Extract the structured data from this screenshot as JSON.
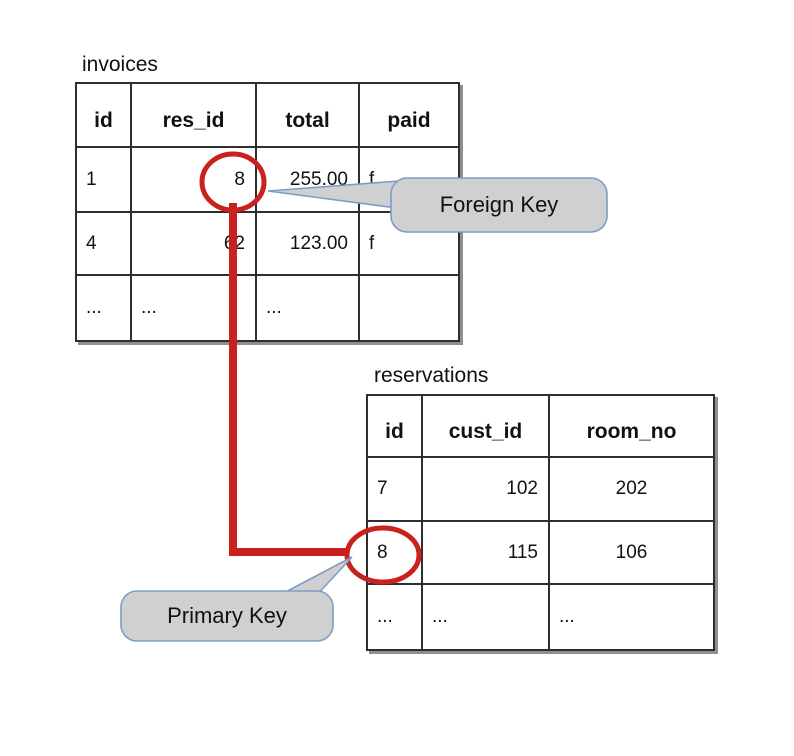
{
  "tables": [
    {
      "name": "invoices",
      "columns": [
        "id",
        "res_id",
        "total",
        "paid"
      ],
      "rows": [
        [
          "1",
          "8",
          "255.00",
          "f"
        ],
        [
          "4",
          "62",
          "123.00",
          "f"
        ],
        [
          "...",
          "...",
          "...",
          ""
        ]
      ]
    },
    {
      "name": "reservations",
      "columns": [
        "id",
        "cust_id",
        "room_no"
      ],
      "rows": [
        [
          "7",
          "102",
          "202"
        ],
        [
          "8",
          "115",
          "106"
        ],
        [
          "...",
          "...",
          "..."
        ]
      ]
    }
  ],
  "annotations": {
    "foreign_key_label": "Foreign Key",
    "primary_key_label": "Primary Key",
    "circled_invoices_res_id": "8",
    "circled_reservations_id": "8"
  },
  "colors": {
    "highlight_red": "#c9211e",
    "callout_fill": "#d0d0d0",
    "callout_border": "#7c9cc9",
    "table_border": "#2e2e2e",
    "text": "#111111",
    "background": "#ffffff"
  }
}
